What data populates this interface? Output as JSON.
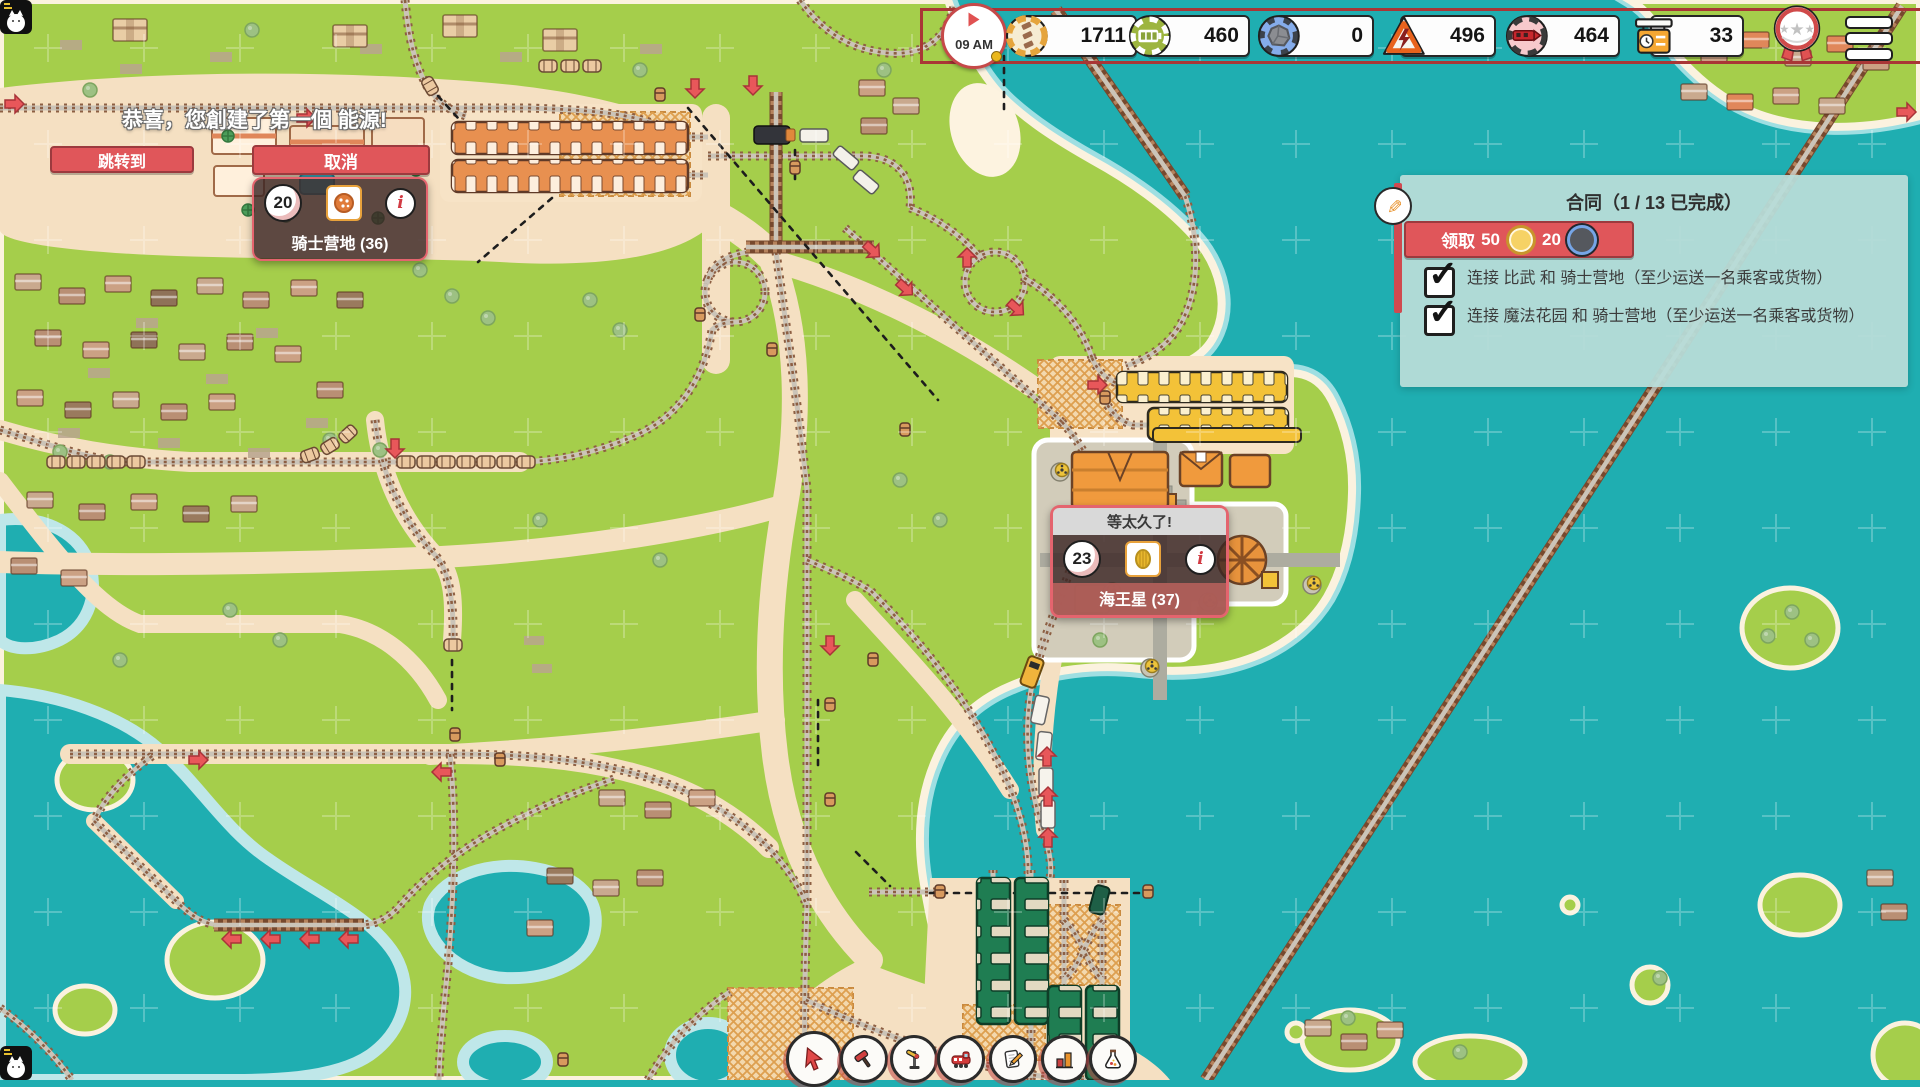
{
  "hud": {
    "time": "09 AM",
    "coins": "1711",
    "energy": "460",
    "coal": "0",
    "hazard": "496",
    "trains": "464",
    "schedule": "33"
  },
  "notification": {
    "message": "恭喜，您創建了第一個 能源!",
    "jump_label": "跳转到"
  },
  "knight_station": {
    "cancel_label": "取消",
    "waiting_count": "20",
    "name": "骑士营地 (36)"
  },
  "neptune_station": {
    "complaint": "等太久了!",
    "waiting_count": "23",
    "name": "海王星 (37)"
  },
  "contracts": {
    "title": "合同（1 / 13 已完成）",
    "claim_label": "领取",
    "claim_money": "50",
    "claim_parts": "20",
    "tasks": [
      {
        "done": true,
        "text": "连接 比武 和 骑士营地（至少运送一名乘客或货物）"
      },
      {
        "done": true,
        "text": "连接 魔法花园 和 骑士营地（至少运送一名乘客或货物）"
      }
    ]
  },
  "toolbar": {
    "tools": [
      "select",
      "demolish",
      "signal",
      "trains",
      "contracts",
      "statistics",
      "research"
    ]
  },
  "colors": {
    "accent_red": "#e0565c",
    "hud_frame_red": "#a93636",
    "panel_mint": "#b7dcd8",
    "water": "#1faeb1",
    "grass": "#a5ce4b",
    "sand": "#f5e0c2",
    "warehouse_green": "#1f7d52",
    "platform_yellow": "#f3c238"
  }
}
